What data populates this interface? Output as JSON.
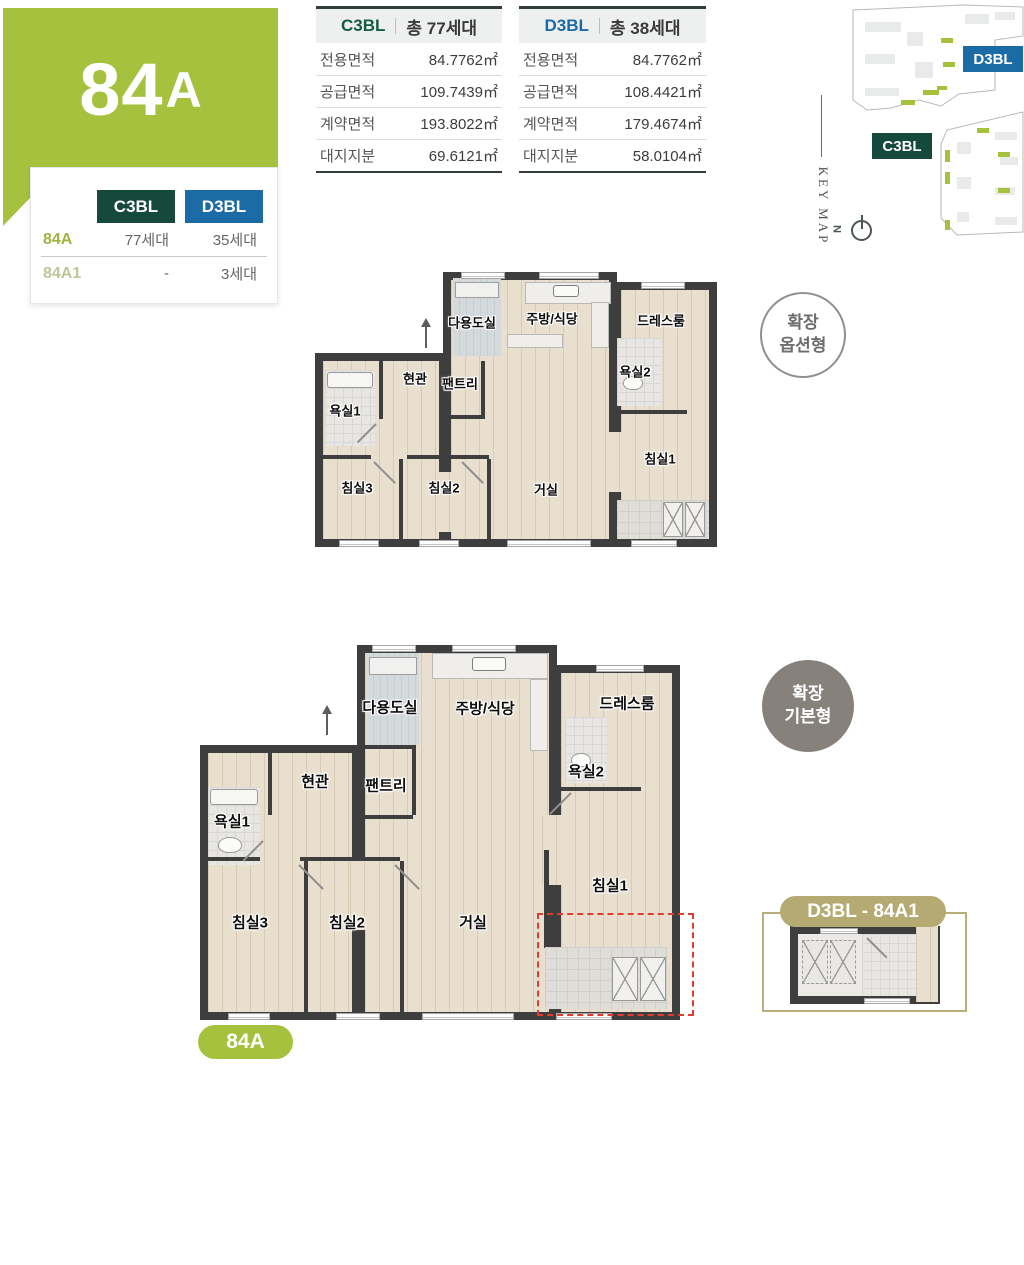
{
  "banner": {
    "title_main": "84",
    "title_sub": "A"
  },
  "unit_table": {
    "col1": "C3BL",
    "col2": "D3BL",
    "rows": [
      {
        "name": "84A",
        "c3bl": "77세대",
        "d3bl": "35세대"
      },
      {
        "name": "84A1",
        "c3bl": "-",
        "d3bl": "3세대"
      }
    ]
  },
  "spec_tables": [
    {
      "block": "C3BL",
      "total": "총 77세대",
      "rows": [
        {
          "label": "전용면적",
          "value": "84.7762㎡"
        },
        {
          "label": "공급면적",
          "value": "109.7439㎡"
        },
        {
          "label": "계약면적",
          "value": "193.8022㎡"
        },
        {
          "label": "대지지분",
          "value": "69.6121㎡"
        }
      ]
    },
    {
      "block": "D3BL",
      "total": "총 38세대",
      "rows": [
        {
          "label": "전용면적",
          "value": "84.7762㎡"
        },
        {
          "label": "공급면적",
          "value": "108.4421㎡"
        },
        {
          "label": "계약면적",
          "value": "179.4674㎡"
        },
        {
          "label": "대지지분",
          "value": "58.0104㎡"
        }
      ]
    }
  ],
  "keymap": {
    "title": "KEY MAP",
    "north": "N",
    "block_top": "D3BL",
    "block_bottom": "C3BL"
  },
  "stamps": {
    "option": {
      "line1": "확장",
      "line2": "옵션형"
    },
    "basic": {
      "line1": "확장",
      "line2": "기본형"
    }
  },
  "rooms": {
    "utility": "다용도실",
    "kitchen": "주방/식당",
    "dressroom": "드레스룸",
    "bathroom2": "욕실2",
    "entrance": "현관",
    "pantry": "팬트리",
    "bathroom1": "욕실1",
    "bedroom3": "침실3",
    "bedroom2": "침실2",
    "livingroom": "거실",
    "bedroom1": "침실1"
  },
  "badges": {
    "plan_type": "84A",
    "inset": "D3BL - 84A1"
  },
  "colors": {
    "green": "#a6c13d",
    "dark_green": "#15493b",
    "blue": "#1b6ba6",
    "tan": "#b5ab72",
    "red_dashed": "#e23b30",
    "wall": "#3e3e3e"
  }
}
